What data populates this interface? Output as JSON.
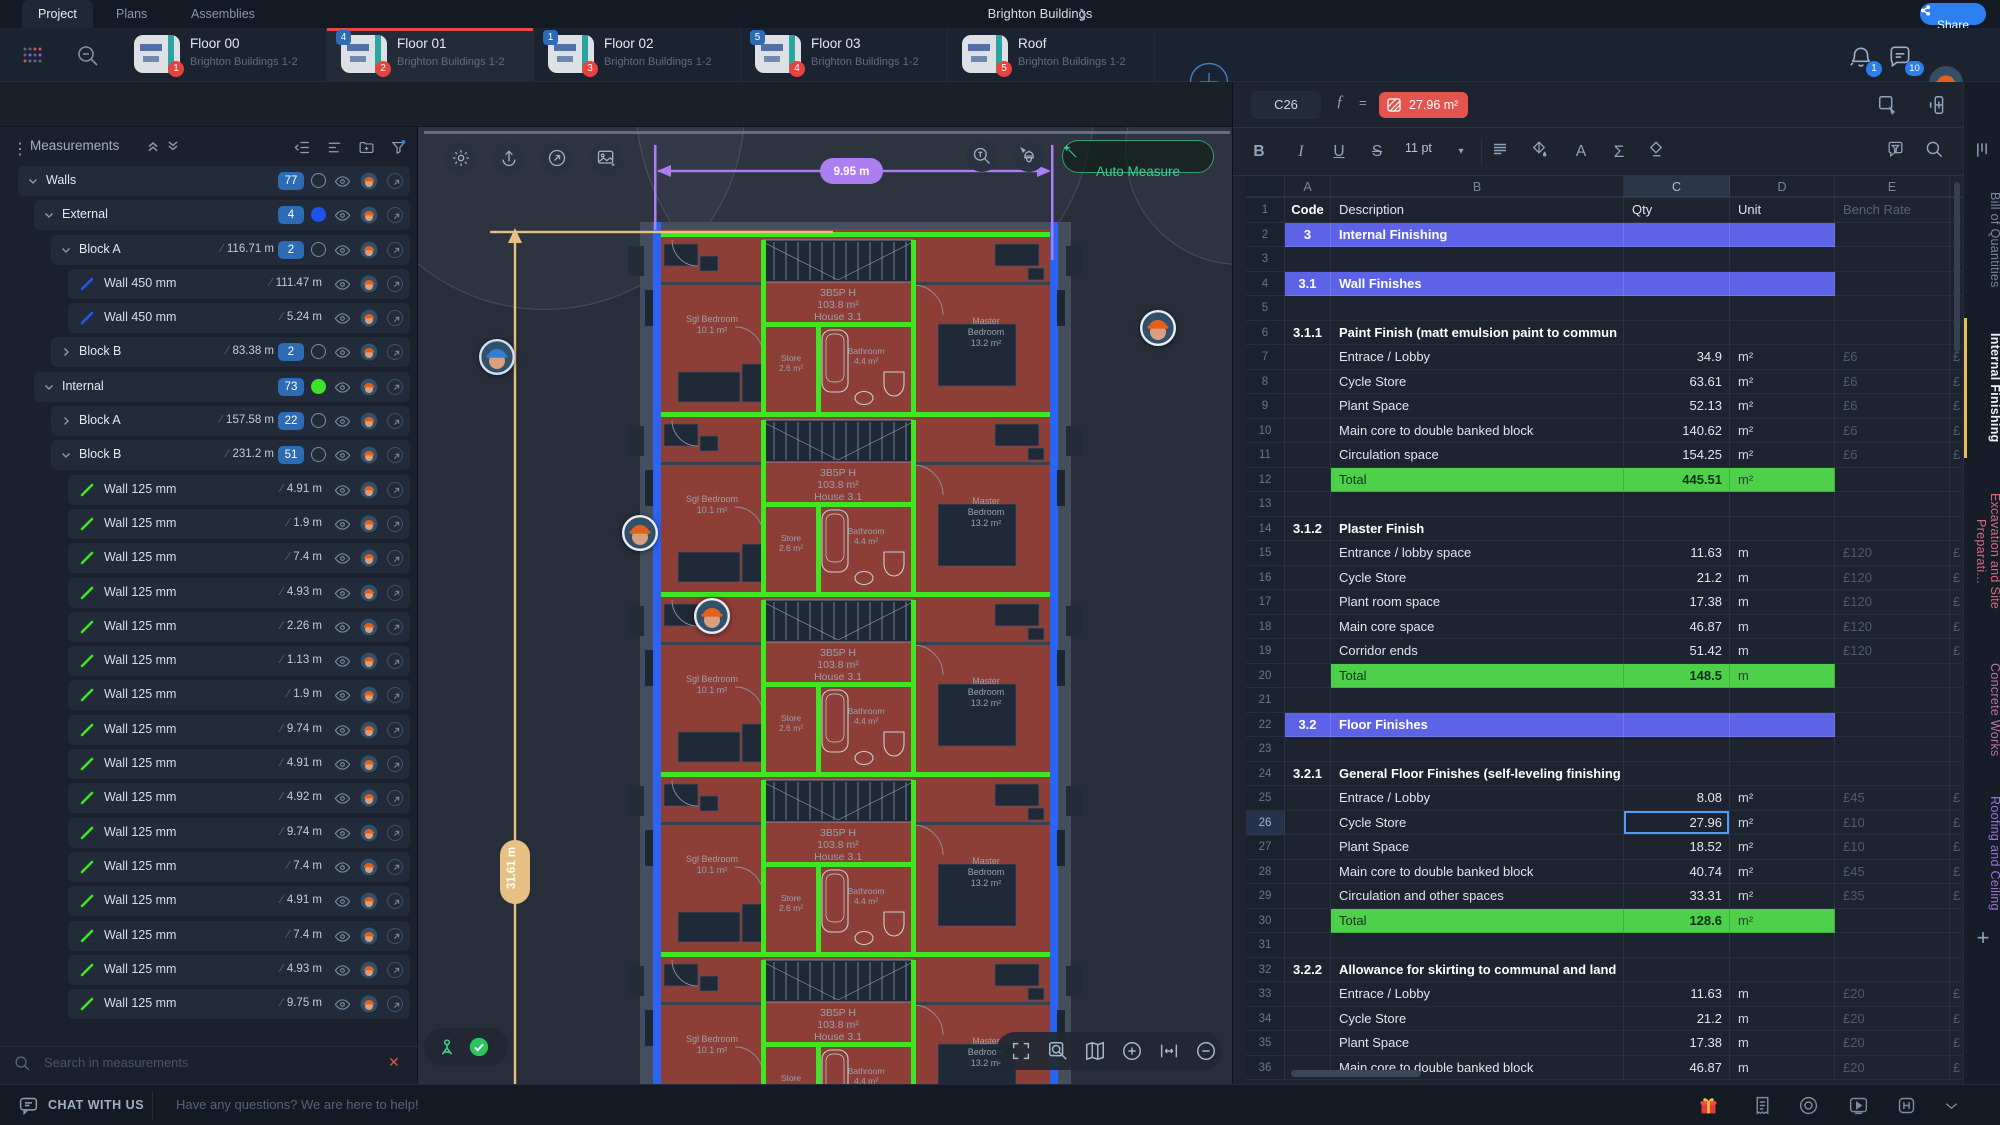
{
  "topbar": {
    "tabs": [
      {
        "label": "Project"
      },
      {
        "label": "Plans"
      },
      {
        "label": "Assemblies"
      }
    ],
    "active_tab": "Project",
    "project_title": "Brighton Buildings",
    "share_label": "Share",
    "bell_badge": "1",
    "chat_badge": "10",
    "left_icons": [
      "apps-grid",
      "zoom-out-search"
    ]
  },
  "floor_tabs": [
    {
      "title": "Floor 00",
      "subtitle": "Brighton Buildings 1-2",
      "page_badge": "1",
      "count_badge": "",
      "active": false
    },
    {
      "title": "Floor 01",
      "subtitle": "Brighton Buildings 1-2",
      "page_badge": "2",
      "count_badge": "4",
      "active": true
    },
    {
      "title": "Floor 02",
      "subtitle": "Brighton Buildings 1-2",
      "page_badge": "3",
      "count_badge": "1",
      "active": false
    },
    {
      "title": "Floor 03",
      "subtitle": "Brighton Buildings 1-2",
      "page_badge": "4",
      "count_badge": "5",
      "active": false
    },
    {
      "title": "Roof",
      "subtitle": "Brighton Buildings 1-2",
      "page_badge": "5",
      "count_badge": "",
      "active": false
    }
  ],
  "draw_toolbar": {
    "icons": [
      "cursor",
      "line",
      "polygon",
      "rectangle",
      "area",
      "zoom-search",
      "count",
      "group-list",
      "note",
      "ruler",
      "document"
    ],
    "selected": "cursor",
    "selection_count": "77"
  },
  "measurements": {
    "title": "Measurements",
    "header_icons": [
      "collapse-all",
      "expand-all",
      "outdent",
      "list-view",
      "add-folder",
      "filter"
    ],
    "search_placeholder": "Search in measurements",
    "tree": [
      {
        "level": 0,
        "name": "Walls",
        "chevron": "down",
        "count": "77",
        "circle": "outline"
      },
      {
        "level": 1,
        "name": "External",
        "chevron": "down",
        "count": "4",
        "circle": "blue"
      },
      {
        "level": 2,
        "name": "Block A",
        "chevron": "down",
        "length": "116.71 m",
        "count": "2",
        "circle": "outline"
      },
      {
        "level": 3,
        "name": "Wall 450 mm",
        "length": "111.47 m",
        "line": "blue"
      },
      {
        "level": 3,
        "name": "Wall 450 mm",
        "length": "5.24 m",
        "line": "blue"
      },
      {
        "level": 2,
        "name": "Block B",
        "chevron": "right",
        "length": "83.38 m",
        "count": "2",
        "circle": "outline"
      },
      {
        "level": 1,
        "name": "Internal",
        "chevron": "down",
        "count": "73",
        "circle": "green"
      },
      {
        "level": 2,
        "name": "Block A",
        "chevron": "right",
        "length": "157.58 m",
        "count": "22",
        "circle": "outline"
      },
      {
        "level": 2,
        "name": "Block B",
        "chevron": "down",
        "length": "231.2 m",
        "count": "51",
        "circle": "outline"
      },
      {
        "level": 3,
        "name": "Wall 125 mm",
        "length": "4.91 m",
        "line": "green"
      },
      {
        "level": 3,
        "name": "Wall 125 mm",
        "length": "1.9 m",
        "line": "green"
      },
      {
        "level": 3,
        "name": "Wall 125 mm",
        "length": "7.4 m",
        "line": "green"
      },
      {
        "level": 3,
        "name": "Wall 125 mm",
        "length": "4.93 m",
        "line": "green"
      },
      {
        "level": 3,
        "name": "Wall 125 mm",
        "length": "2.26 m",
        "line": "green"
      },
      {
        "level": 3,
        "name": "Wall 125 mm",
        "length": "1.13 m",
        "line": "green"
      },
      {
        "level": 3,
        "name": "Wall 125 mm",
        "length": "1.9 m",
        "line": "green"
      },
      {
        "level": 3,
        "name": "Wall 125 mm",
        "length": "9.74 m",
        "line": "green"
      },
      {
        "level": 3,
        "name": "Wall 125 mm",
        "length": "4.91 m",
        "line": "green"
      },
      {
        "level": 3,
        "name": "Wall 125 mm",
        "length": "4.92 m",
        "line": "green"
      },
      {
        "level": 3,
        "name": "Wall 125 mm",
        "length": "9.74 m",
        "line": "green"
      },
      {
        "level": 3,
        "name": "Wall 125 mm",
        "length": "7.4 m",
        "line": "green"
      },
      {
        "level": 3,
        "name": "Wall 125 mm",
        "length": "4.91 m",
        "line": "green"
      },
      {
        "level": 3,
        "name": "Wall 125 mm",
        "length": "7.4 m",
        "line": "green"
      },
      {
        "level": 3,
        "name": "Wall 125 mm",
        "length": "4.93 m",
        "line": "green"
      },
      {
        "level": 3,
        "name": "Wall 125 mm",
        "length": "9.75 m",
        "line": "green"
      }
    ]
  },
  "canvas": {
    "auto_measure": "Auto Measure",
    "dim_horizontal": "9.95 m",
    "dim_vertical": "31.61 m",
    "corner_icons": [
      "settings",
      "export",
      "open-link",
      "add-image"
    ],
    "zoom_icons": [
      "fullscreen",
      "zoom-area",
      "map",
      "zoom-in",
      "fit-width",
      "zoom-out"
    ],
    "plan_labels": {
      "house": [
        "3B5P H",
        "103.8 m²",
        "House 3.1"
      ],
      "sgl_bedroom": [
        "Sgl Bedroom",
        "10.1 m²"
      ],
      "master_bedroom": [
        "Master",
        "Bedroom",
        "13.2 m²"
      ],
      "store": [
        "Store",
        "2.6 m²"
      ],
      "bathroom": [
        "Bathroom",
        "4.4 m²"
      ]
    }
  },
  "formula_bar": {
    "cell_ref": "C26",
    "fx": "ƒ",
    "equals": "=",
    "value": "27.96 m²",
    "right_icons": [
      "select-range",
      "add-column",
      "more"
    ]
  },
  "sheet_toolbar": {
    "bold": "B",
    "italic": "I",
    "underline": "U",
    "strike": "S",
    "font_size": "11 pt",
    "font_color": "A",
    "sum": "Σ"
  },
  "sheet": {
    "col_letters": [
      "A",
      "B",
      "C",
      "D",
      "E"
    ],
    "selection": {
      "ref": "C26",
      "row": 26,
      "col": "C"
    },
    "header": {
      "code": "Code",
      "desc": "Description",
      "qty": "Qty",
      "unit": "Unit",
      "rate": "Bench Rate"
    },
    "rows": [
      {
        "n": 1,
        "type": "colhead"
      },
      {
        "n": 2,
        "type": "section",
        "code": "3",
        "desc": "Internal Finishing"
      },
      {
        "n": 3,
        "type": "empty"
      },
      {
        "n": 4,
        "type": "section",
        "code": "3.1",
        "desc": "Wall Finishes"
      },
      {
        "n": 5,
        "type": "empty"
      },
      {
        "n": 6,
        "type": "sub",
        "code": "3.1.1",
        "desc": "Paint Finish (matt emulsion paint to commun"
      },
      {
        "n": 7,
        "type": "item",
        "desc": "Entrace / Lobby",
        "qty": "34.9",
        "unit": "m²",
        "rate": "£6"
      },
      {
        "n": 8,
        "type": "item",
        "desc": "Cycle Store",
        "qty": "63.61",
        "unit": "m²",
        "rate": "£6"
      },
      {
        "n": 9,
        "type": "item",
        "desc": "Plant Space",
        "qty": "52.13",
        "unit": "m²",
        "rate": "£6"
      },
      {
        "n": 10,
        "type": "item",
        "desc": "Main core to double banked block",
        "qty": "140.62",
        "unit": "m²",
        "rate": "£6"
      },
      {
        "n": 11,
        "type": "item",
        "desc": "Circulation space",
        "qty": "154.25",
        "unit": "m²",
        "rate": "£6"
      },
      {
        "n": 12,
        "type": "total",
        "desc": "Total",
        "qty": "445.51",
        "unit": "m²"
      },
      {
        "n": 13,
        "type": "empty"
      },
      {
        "n": 14,
        "type": "sub",
        "code": "3.1.2",
        "desc": "Plaster Finish"
      },
      {
        "n": 15,
        "type": "item",
        "desc": "Entrance / lobby space",
        "qty": "11.63",
        "unit": "m",
        "rate": "£120"
      },
      {
        "n": 16,
        "type": "item",
        "desc": "Cycle Store",
        "qty": "21.2",
        "unit": "m",
        "rate": "£120"
      },
      {
        "n": 17,
        "type": "item",
        "desc": "Plant room space",
        "qty": "17.38",
        "unit": "m",
        "rate": "£120"
      },
      {
        "n": 18,
        "type": "item",
        "desc": "Main core space",
        "qty": "46.87",
        "unit": "m",
        "rate": "£120"
      },
      {
        "n": 19,
        "type": "item",
        "desc": "Corridor ends",
        "qty": "51.42",
        "unit": "m",
        "rate": "£120"
      },
      {
        "n": 20,
        "type": "total",
        "desc": "Total",
        "qty": "148.5",
        "unit": "m"
      },
      {
        "n": 21,
        "type": "empty"
      },
      {
        "n": 22,
        "type": "section",
        "code": "3.2",
        "desc": "Floor Finishes"
      },
      {
        "n": 23,
        "type": "empty"
      },
      {
        "n": 24,
        "type": "sub",
        "code": "3.2.1",
        "desc": "General Floor Finishes (self-leveling finishing"
      },
      {
        "n": 25,
        "type": "item",
        "desc": "Entrace / Lobby",
        "qty": "8.08",
        "unit": "m²",
        "rate": "£45"
      },
      {
        "n": 26,
        "type": "item",
        "desc": "Cycle Store",
        "qty": "27.96",
        "unit": "m²",
        "rate": "£10"
      },
      {
        "n": 27,
        "type": "item",
        "desc": "Plant Space",
        "qty": "18.52",
        "unit": "m²",
        "rate": "£10"
      },
      {
        "n": 28,
        "type": "item",
        "desc": "Main core to double banked block",
        "qty": "40.74",
        "unit": "m²",
        "rate": "£45"
      },
      {
        "n": 29,
        "type": "item",
        "desc": "Circulation and other spaces",
        "qty": "33.31",
        "unit": "m²",
        "rate": "£35"
      },
      {
        "n": 30,
        "type": "total",
        "desc": "Total",
        "qty": "128.6",
        "unit": "m²"
      },
      {
        "n": 31,
        "type": "empty"
      },
      {
        "n": 32,
        "type": "sub",
        "code": "3.2.2",
        "desc": "Allowance for skirting to communal and land"
      },
      {
        "n": 33,
        "type": "item",
        "desc": "Entrace / Lobby",
        "qty": "11.63",
        "unit": "m",
        "rate": "£20"
      },
      {
        "n": 34,
        "type": "item",
        "desc": "Cycle Store",
        "qty": "21.2",
        "unit": "m",
        "rate": "£20"
      },
      {
        "n": 35,
        "type": "item",
        "desc": "Plant Space",
        "qty": "17.38",
        "unit": "m",
        "rate": "£20"
      },
      {
        "n": 36,
        "type": "item",
        "desc": "Main core to double banked block",
        "qty": "46.87",
        "unit": "m",
        "rate": "£20"
      }
    ]
  },
  "rail_tabs": [
    {
      "label": "Bill of Quantities",
      "color": "#76859a",
      "active": false
    },
    {
      "label": "Internal Finishing",
      "color": "#eef2f7",
      "active": true
    },
    {
      "label": "Excavation and Site Preparati...",
      "color": "#d06a7c",
      "active": false
    },
    {
      "label": "Concrete Works",
      "color": "#bd6fa0",
      "active": false
    },
    {
      "label": "Roofing and Ceiling",
      "color": "#9a70d8",
      "active": false
    }
  ],
  "statusbar": {
    "chat_label": "CHAT WITH US",
    "message": "Have any questions? We are here to help!",
    "right_icons": [
      "gift",
      "invoice",
      "help",
      "video",
      "shortcuts",
      "collapse"
    ]
  },
  "colors": {
    "accent": "#2d7ff0",
    "measure_green": "#3fe622",
    "external_blue": "#1f53f0",
    "section_purple": "#5d63e6",
    "total_green": "#4ed04b",
    "chip_red": "#e4544f",
    "dim_purple": "#ad7ef2",
    "dim_tan": "#e7c083",
    "active_red": "#e8484a"
  }
}
